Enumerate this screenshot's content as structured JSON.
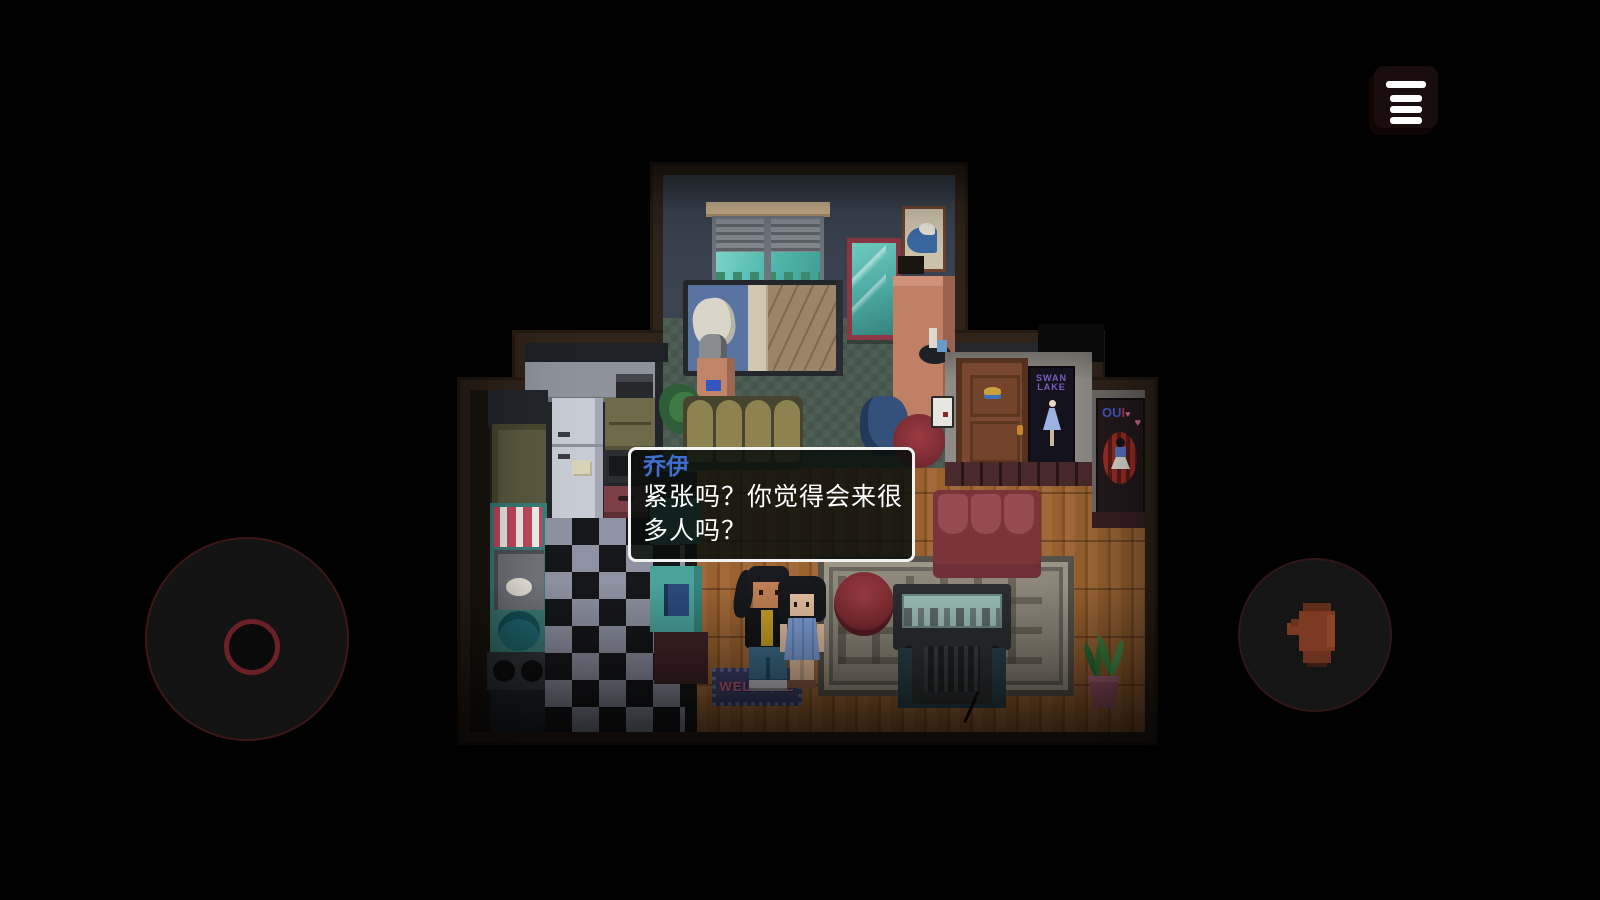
{
  "ui": {
    "menu_button": {
      "icon": "hamburger-icon"
    },
    "joystick": {
      "role": "virtual-joystick"
    },
    "action_button": {
      "icon": "hand-icon"
    }
  },
  "dialogue": {
    "speaker": "乔伊",
    "lines": [
      "紧张吗？你觉得会来很",
      "多人吗？"
    ],
    "full_text": "紧张吗？你觉得会来很多人吗？",
    "speaker_color": "#3f6ed0",
    "text_color": "#ffffff"
  },
  "scene": {
    "welcome_mat_text": "WELCOME",
    "swan_poster": {
      "line1": "SWAN",
      "line2": "LAKE"
    },
    "out_poster": {
      "letters": [
        "O",
        "U",
        "I"
      ],
      "heart": "♥"
    }
  },
  "colors": {
    "dialog_border": "#f2f2f2",
    "joystick_ring": "#6b2026",
    "hand_icon": "#7c3a23",
    "wood_floor": "#a26a3a",
    "bedroom_wall": "#3a434f"
  }
}
